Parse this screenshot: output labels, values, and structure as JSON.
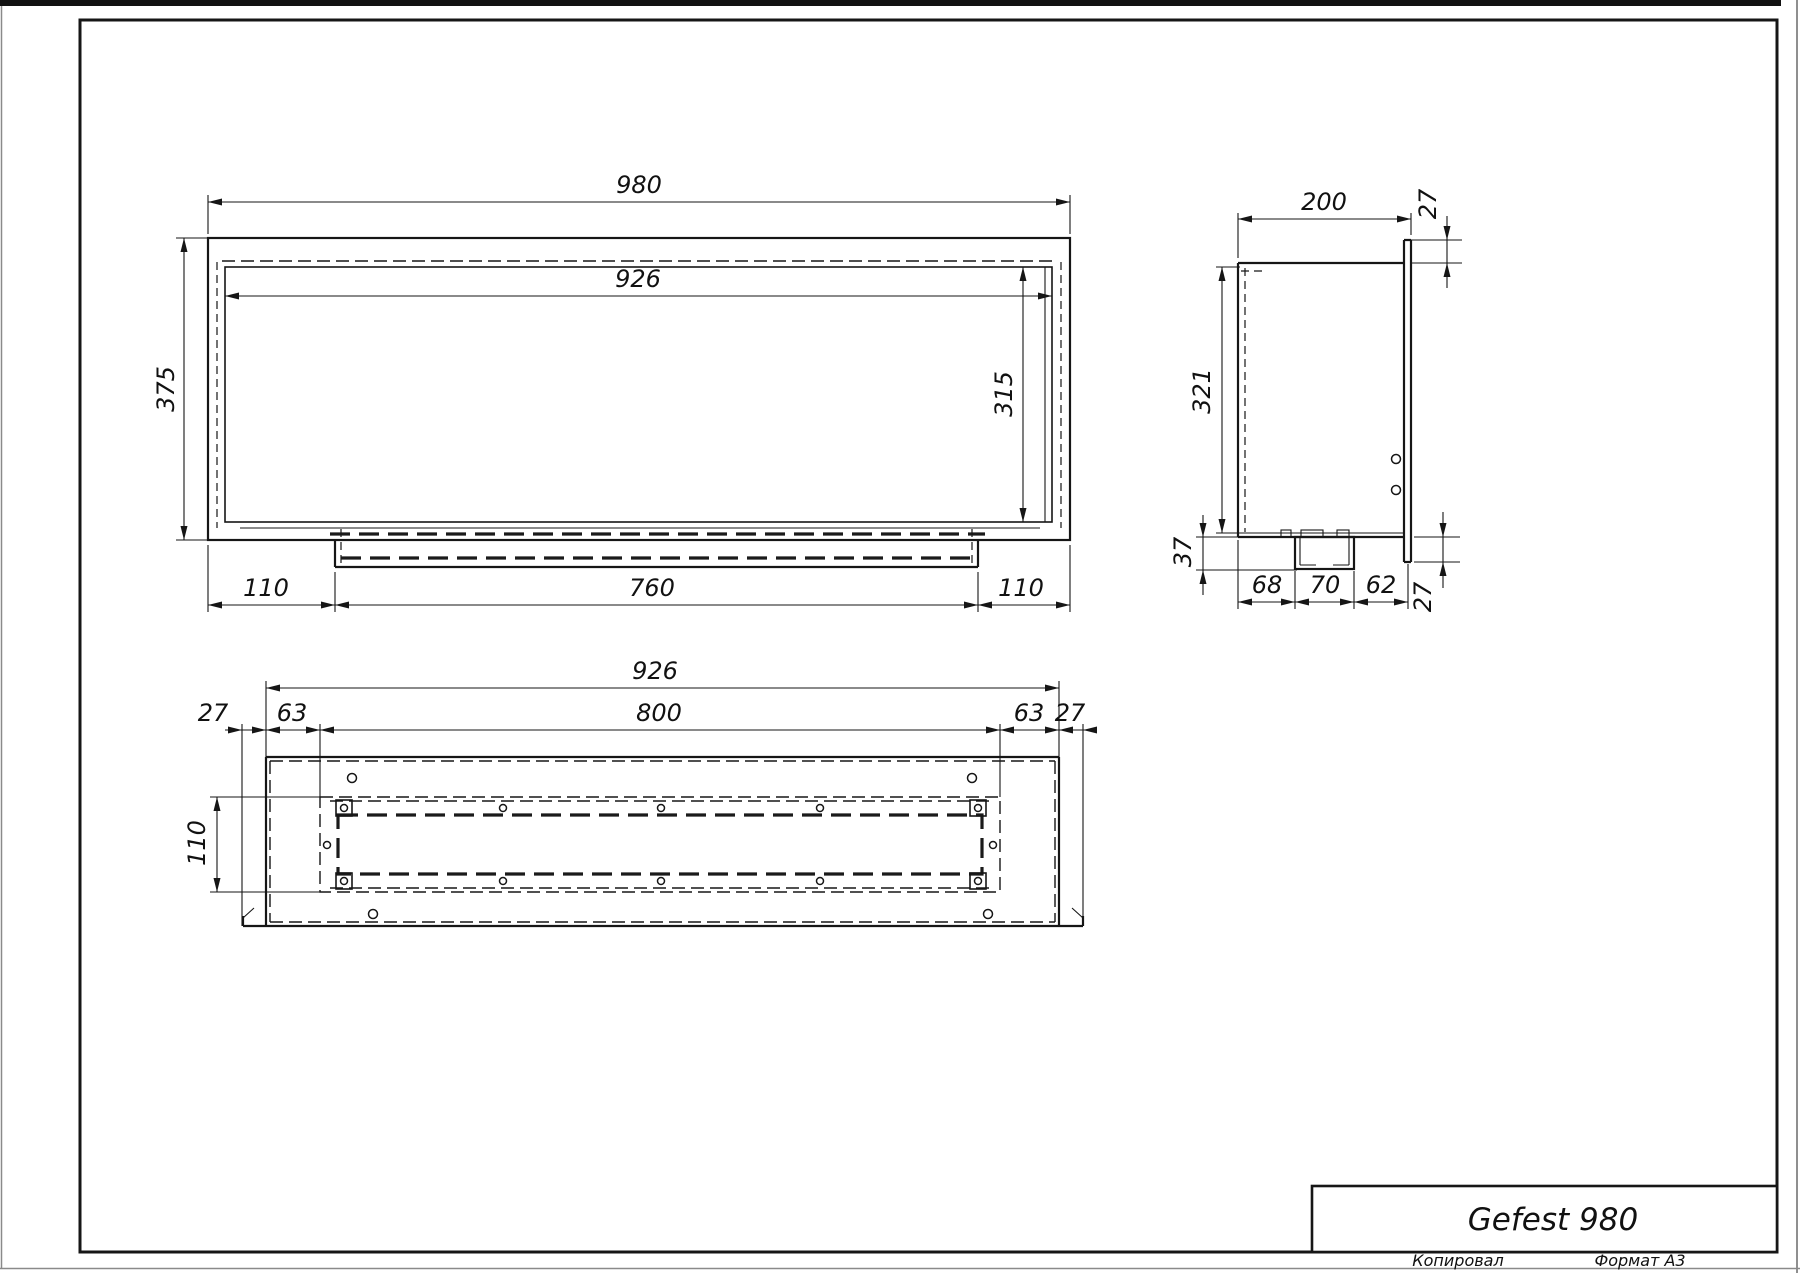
{
  "colors": {
    "line": "#161616",
    "background": "#ffffff"
  },
  "title_block": {
    "title": "Gefest 980",
    "copied_label": "Копировал",
    "format_label": "Формат A3"
  },
  "front_view": {
    "width": "980",
    "inner_width": "926",
    "height": "375",
    "inner_height": "315",
    "bottom_left": "110",
    "bottom_center": "760",
    "bottom_right": "110"
  },
  "side_view": {
    "depth": "200",
    "top_flange": "27",
    "inner_height": "321",
    "tray_drop": "37",
    "bottom_left": "68",
    "bottom_center": "70",
    "bottom_right": "62",
    "bottom_flange": "27"
  },
  "plan_view": {
    "inner_width": "926",
    "burner_width": "800",
    "left_margin": "27",
    "left_inset": "63",
    "right_inset": "63",
    "right_margin": "27",
    "tray_depth": "110"
  }
}
